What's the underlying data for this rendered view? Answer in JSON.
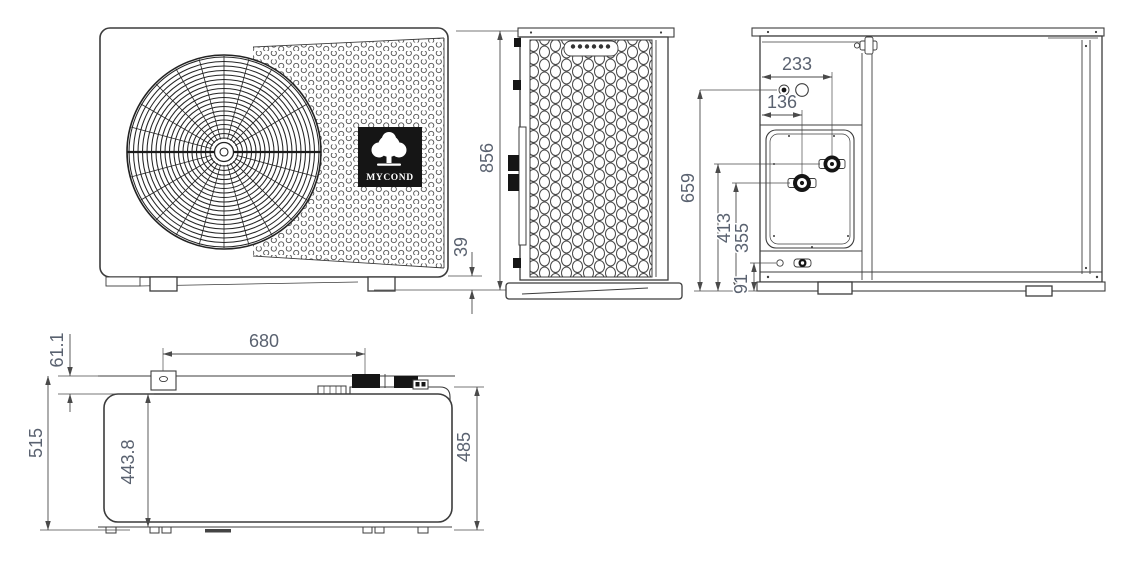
{
  "drawing": {
    "type": "technical-dimension-drawing",
    "subject": "heat pump outdoor unit",
    "colors": {
      "line": "#3c3c3c",
      "dimension_text": "#5a6270",
      "black_fill": "#151515",
      "background": "#ffffff"
    }
  },
  "views": {
    "front": {
      "logo_text": "MYCOND",
      "dims": {
        "foot_height": "39"
      }
    },
    "side": {
      "dims": {
        "overall_height": "856"
      }
    },
    "back": {
      "dims": {
        "top_port_offset": "233",
        "inner_port_offset": "136",
        "upper_circles_height": "659",
        "outlet_height": "413",
        "inlet_height": "355",
        "drain_height": "91"
      }
    },
    "top": {
      "dims": {
        "back_edge_offset": "61.1",
        "bracket_spacing": "680",
        "overall_depth": "515",
        "body_depth": "443.8",
        "cover_depth": "485"
      }
    }
  }
}
